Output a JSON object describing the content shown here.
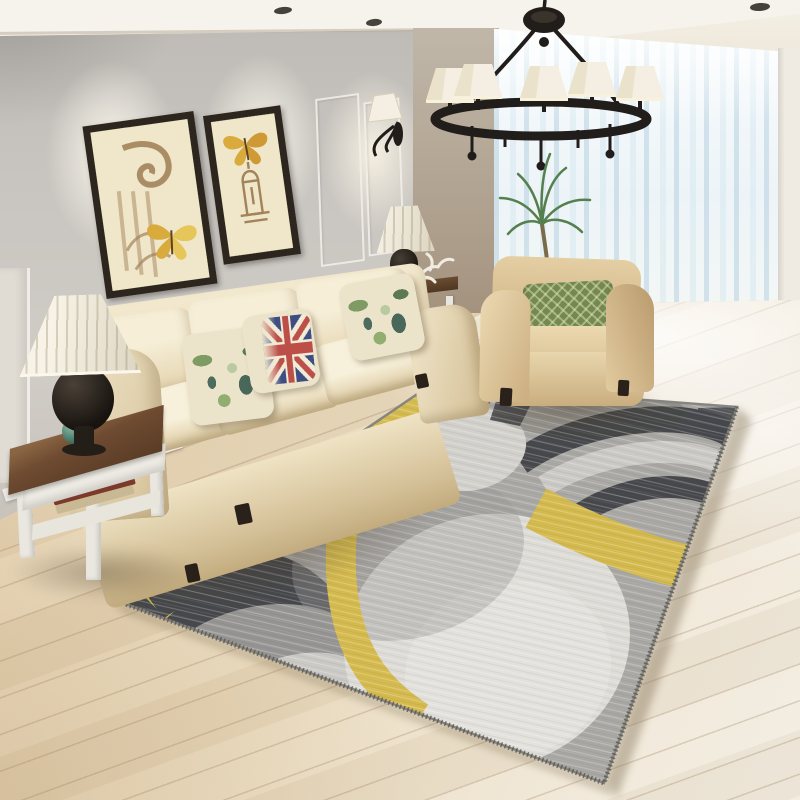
{
  "scene": {
    "objects": [
      "ceiling-with-recessed-spotlights",
      "gray-accent-wall",
      "framed-butterfly-art-left",
      "framed-butterfly-art-right",
      "wall-sconce",
      "dark-teal-curtain",
      "sheer-window",
      "white-pillar",
      "wood-plank-floor",
      "black-iron-chandelier-with-cream-shades",
      "cream-three-seat-sofa",
      "floral-pillows",
      "union-jack-pillow",
      "console-table-with-lamp",
      "antler-decor",
      "palm-plant",
      "beige-armchair",
      "green-diamond-pillow",
      "white-side-table",
      "stacked-books",
      "teal-ball-decor",
      "pleated-table-lamp",
      "geometric-area-rug-yellow-gray-charcoal-circles"
    ]
  },
  "palette": {
    "ceiling": "#f6f3ec",
    "wall": "#c6c2bd",
    "wainscotCol": "#e0dcd4",
    "spotCol": "#45413b",
    "curtainTeal": "#22403e",
    "windowCol": "#eef5f8",
    "pillarCol": "#efebe2",
    "floor": "#e2cfae",
    "sofaCream": "#eee3c6",
    "armchairTan": "#d5ba8c",
    "pillowCream": "#ece3cb",
    "ujRed": "#b8443f",
    "ujBlue": "#31427c",
    "greenPillow": "#75884f",
    "rugBase": "#a8a7a3",
    "rugWhite": "#dddbd6",
    "rugLight": "#cbc9c5",
    "rugMid": "#9a9996",
    "rugDark": "#45474b",
    "rugYellow": "#d4b94c",
    "rugEdge": "#87857f",
    "tableWood": "#6e4b31",
    "whitePaint": "#eae7e0",
    "lampShade": "#f4efe2",
    "lampBase": "#18130f",
    "metalBlack": "#211d1a",
    "frameDark": "#2c261f",
    "artBg": "#f0e6ca",
    "artSepia": "#a3835a",
    "butterflyYellow": "#d9aa3c",
    "plantGreen": "#55804d",
    "bookGreen": "#2e5b4e",
    "bookRed": "#7c3a2a",
    "footCol": "#2a211a"
  }
}
